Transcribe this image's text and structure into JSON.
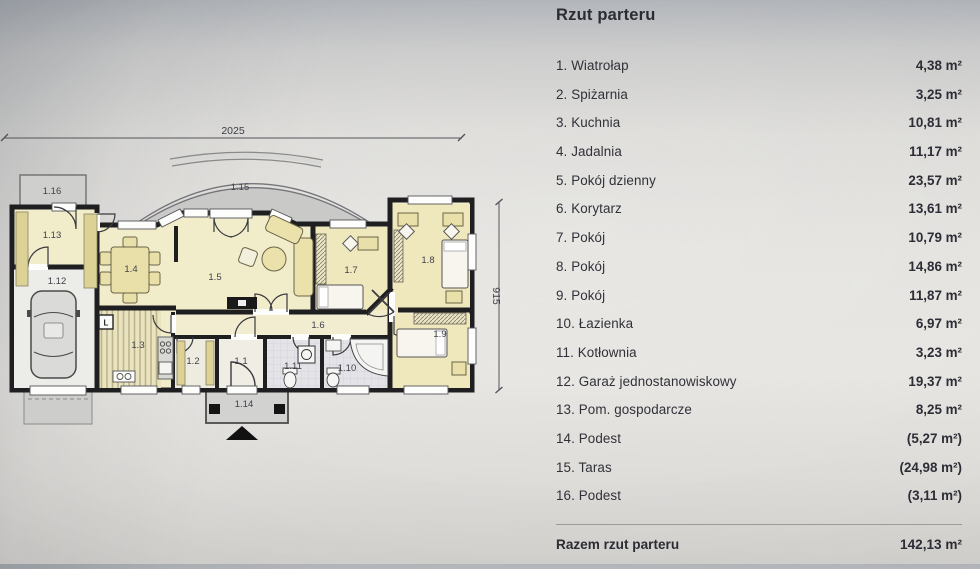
{
  "title": "Rzut parteru",
  "list": {
    "items": [
      {
        "label": "1. Wiatrołap",
        "area": "4,38 m²"
      },
      {
        "label": "2. Spiżarnia",
        "area": "3,25 m²"
      },
      {
        "label": "3. Kuchnia",
        "area": "10,81 m²"
      },
      {
        "label": "4. Jadalnia",
        "area": "11,17 m²"
      },
      {
        "label": "5. Pokój dzienny",
        "area": "23,57 m²"
      },
      {
        "label": "6. Korytarz",
        "area": "13,61 m²"
      },
      {
        "label": "7. Pokój",
        "area": "10,79 m²"
      },
      {
        "label": "8. Pokój",
        "area": "14,86 m²"
      },
      {
        "label": "9. Pokój",
        "area": "11,87 m²"
      },
      {
        "label": "10. Łazienka",
        "area": "6,97 m²"
      },
      {
        "label": "11. Kotłownia",
        "area": "3,23 m²"
      },
      {
        "label": "12. Garaż jednostanowiskowy",
        "area": "19,37 m²"
      },
      {
        "label": "13. Pom. gospodarcze",
        "area": "8,25 m²"
      },
      {
        "label": "14. Podest",
        "area": "(5,27 m²)"
      },
      {
        "label": "15. Taras",
        "area": "(24,98 m²)"
      },
      {
        "label": "16. Podest",
        "area": "(3,11 m²)"
      }
    ],
    "total_label": "Razem rzut parteru",
    "total_area": "142,13 m²"
  },
  "plan": {
    "dimensions": {
      "width": "2025",
      "height": "915"
    },
    "room_numbers": [
      "1.1",
      "1.2",
      "1.3",
      "1.4",
      "1.5",
      "1.6",
      "1.7",
      "1.8",
      "1.9",
      "1.10",
      "1.11",
      "1.12",
      "1.13",
      "1.14",
      "1.15",
      "1.16"
    ],
    "fridge_marker": "L"
  },
  "colors": {
    "wall": "#1f1f22",
    "floor_yellow": "#f1ecca",
    "bedroom_yellow": "#efe8bd",
    "terrace_gray": "#c9c9c7",
    "tile_gray": "#e4e4e8",
    "furniture_tan": "#e9e0a9"
  }
}
